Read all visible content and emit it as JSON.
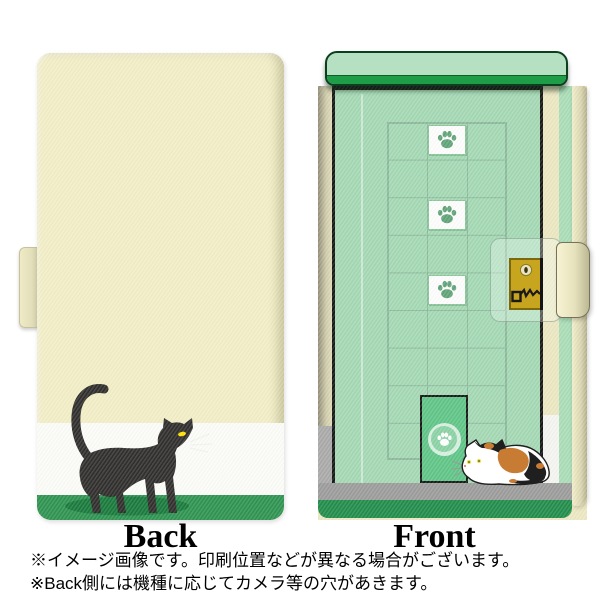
{
  "page": {
    "background": "#ffffff",
    "type": "product-image-phone-flip-case"
  },
  "views": {
    "back": {
      "label": "Back"
    },
    "front": {
      "label": "Front"
    }
  },
  "notes": {
    "line1": "※イメージ画像です。印刷位置などが異なる場合がございます。",
    "line2": "※Back側には機種に応じてカメラ等の穴があきます。"
  },
  "icons": {
    "back_illustration": "black-cat-walking-icon",
    "front_illustration": "calico-cat-crouching-icon",
    "window_icon": "paw-print-icon",
    "pet_door_icon": "paw-print-icon",
    "clasp_icons": [
      "keyhole-icon",
      "key-scratch-icon"
    ]
  },
  "counts": {
    "paw_windows": 3
  },
  "colors": {
    "case_cream": "#f2eec6",
    "back_white_stripe": "#fbfbf8",
    "back_green_stripe": "#2d9350",
    "cat_shadow_green": "#17793b",
    "black_cat": "#2e2d2b",
    "cat_eye_yellow": "#ffdf00",
    "door_green": "#a3d8b3",
    "top_bar_green": "#b5e1c2",
    "top_bar_band_green": "#1f9c48",
    "grid_line_green": "#8cb89b",
    "paw_green": "#5fa377",
    "pet_door_green": "#5ec586",
    "floor_gray": "#9b9b9b",
    "base_green": "#208c4a",
    "gold_plate": "#c7a51e",
    "calico_orange": "#c87c33"
  }
}
